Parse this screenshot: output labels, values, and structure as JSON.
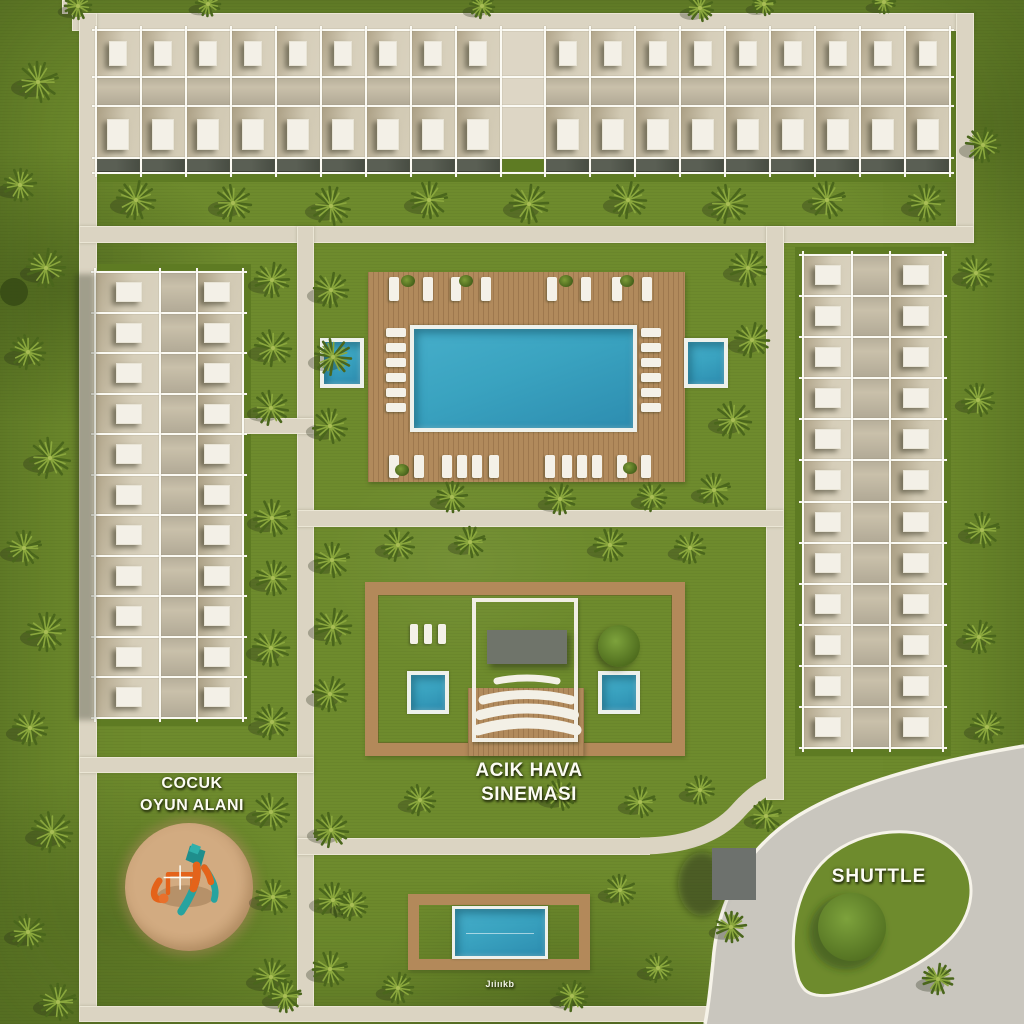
{
  "labels": {
    "playground_line1": "COCUK",
    "playground_line2": "OYUN ALANI",
    "cinema_line1": "ACIK HAVA",
    "cinema_line2": "SINEMASI",
    "shuttle": "SHUTTLE",
    "kids_pool_caption": "Jıiııkb"
  },
  "colors": {
    "grass": "#6e8b2d",
    "grass_dark": "#5e7b23",
    "path": "#dbd4c2",
    "road": "#c9c6be",
    "road_edge": "#f6f3e9",
    "wood": "#b18a5c",
    "water": "#3aa3c0",
    "sky": "#f3f0e7",
    "screen": "#6f746a",
    "shuttle_building": "#6d716d",
    "sand": "#c9a177",
    "play_teal": "#27a39f",
    "play_orange": "#e4631a"
  },
  "buildings": {
    "top": {
      "x": 96,
      "y": 30,
      "w": 854,
      "h": 143,
      "columns": 19,
      "entrance_column": 9,
      "rows": 2
    },
    "left": {
      "x": 95,
      "y": 272,
      "w": 148,
      "h": 446,
      "rows": 11,
      "unit_columns": 2
    },
    "right": {
      "x": 803,
      "y": 255,
      "w": 140,
      "h": 493,
      "rows": 12,
      "unit_columns": 2
    }
  },
  "pool": {
    "deck": [
      368,
      272,
      317,
      210
    ],
    "main": [
      410,
      325,
      227,
      107
    ],
    "side_left": [
      320,
      338,
      44,
      50
    ],
    "side_right": [
      684,
      338,
      44,
      50
    ],
    "left_col_x": 386,
    "right_col_x": 641,
    "col_ys": [
      328,
      343,
      358,
      373,
      388,
      403
    ],
    "top_row_y": 277,
    "top_xs": [
      389,
      423,
      451,
      481,
      547,
      581,
      612,
      642
    ],
    "bottom_row_y": 455,
    "bottom_xs": [
      389,
      414,
      442,
      457,
      472,
      489,
      545,
      562,
      577,
      592,
      617,
      641
    ],
    "plants_top": [
      [
        408,
        281
      ],
      [
        466,
        281
      ],
      [
        566,
        281
      ],
      [
        627,
        281
      ]
    ],
    "plants_bottom": [
      [
        402,
        470
      ],
      [
        630,
        468
      ]
    ]
  },
  "cinema": {
    "ring": [
      365,
      582,
      320,
      174
    ],
    "wood_center": [
      468,
      688,
      116,
      68
    ],
    "frame": [
      472,
      598,
      106,
      144
    ],
    "screen": [
      487,
      630,
      80,
      34
    ],
    "pool_left": [
      407,
      671,
      42,
      43
    ],
    "pool_right": [
      598,
      671,
      42,
      43
    ],
    "mini_loungers_x": [
      410,
      424,
      438
    ],
    "mini_y": 624,
    "bush": [
      619,
      646,
      21
    ]
  },
  "playground": {
    "sand": [
      189,
      887,
      64
    ]
  },
  "kids_pool": {
    "ring": [
      408,
      894,
      182,
      76
    ],
    "pool": [
      452,
      906,
      96,
      53
    ]
  },
  "shuttle": {
    "building": [
      712,
      848,
      44,
      52
    ],
    "island_bush": [
      852,
      927,
      34
    ]
  },
  "trees": [
    [
      38,
      82,
      20
    ],
    [
      20,
      185,
      16
    ],
    [
      46,
      268,
      19
    ],
    [
      28,
      352,
      17
    ],
    [
      50,
      458,
      20
    ],
    [
      24,
      548,
      17
    ],
    [
      46,
      632,
      19
    ],
    [
      30,
      728,
      17
    ],
    [
      52,
      832,
      20
    ],
    [
      28,
      932,
      17
    ],
    [
      58,
      1002,
      18
    ],
    [
      78,
      6,
      13
    ],
    [
      208,
      4,
      12
    ],
    [
      482,
      6,
      12
    ],
    [
      700,
      8,
      13
    ],
    [
      764,
      4,
      11
    ],
    [
      884,
      2,
      11
    ],
    [
      136,
      200,
      19
    ],
    [
      233,
      203,
      18
    ],
    [
      331,
      206,
      19
    ],
    [
      429,
      200,
      18
    ],
    [
      529,
      204,
      19
    ],
    [
      628,
      200,
      18
    ],
    [
      728,
      204,
      19
    ],
    [
      827,
      200,
      18
    ],
    [
      926,
      203,
      18
    ],
    [
      272,
      280,
      17
    ],
    [
      273,
      348,
      18
    ],
    [
      271,
      408,
      17
    ],
    [
      272,
      518,
      18
    ],
    [
      273,
      578,
      17
    ],
    [
      271,
      648,
      18
    ],
    [
      272,
      722,
      17
    ],
    [
      271,
      812,
      18
    ],
    [
      273,
      897,
      17
    ],
    [
      271,
      977,
      18
    ],
    [
      331,
      290,
      17
    ],
    [
      333,
      357,
      18
    ],
    [
      330,
      426,
      17
    ],
    [
      332,
      560,
      17
    ],
    [
      333,
      627,
      18
    ],
    [
      330,
      694,
      17
    ],
    [
      331,
      830,
      17
    ],
    [
      333,
      900,
      17
    ],
    [
      330,
      969,
      17
    ],
    [
      748,
      268,
      18
    ],
    [
      752,
      340,
      17
    ],
    [
      733,
      420,
      18
    ],
    [
      714,
      490,
      16
    ],
    [
      452,
      497,
      15
    ],
    [
      560,
      499,
      15
    ],
    [
      652,
      497,
      14
    ],
    [
      398,
      545,
      16
    ],
    [
      470,
      542,
      15
    ],
    [
      610,
      545,
      16
    ],
    [
      690,
      548,
      15
    ],
    [
      420,
      800,
      15
    ],
    [
      560,
      795,
      15
    ],
    [
      640,
      802,
      15
    ],
    [
      700,
      790,
      14
    ],
    [
      983,
      145,
      17
    ],
    [
      976,
      273,
      17
    ],
    [
      978,
      400,
      16
    ],
    [
      982,
      530,
      17
    ],
    [
      979,
      637,
      16
    ],
    [
      987,
      727,
      16
    ],
    [
      352,
      905,
      15
    ],
    [
      620,
      890,
      15
    ],
    [
      285,
      996,
      16
    ],
    [
      398,
      988,
      15
    ],
    [
      572,
      996,
      15
    ],
    [
      658,
      968,
      14
    ],
    [
      766,
      816,
      15
    ],
    [
      731,
      927,
      15
    ],
    [
      938,
      979,
      15
    ]
  ],
  "dark_bushes": [
    [
      14,
      292,
      14
    ]
  ]
}
